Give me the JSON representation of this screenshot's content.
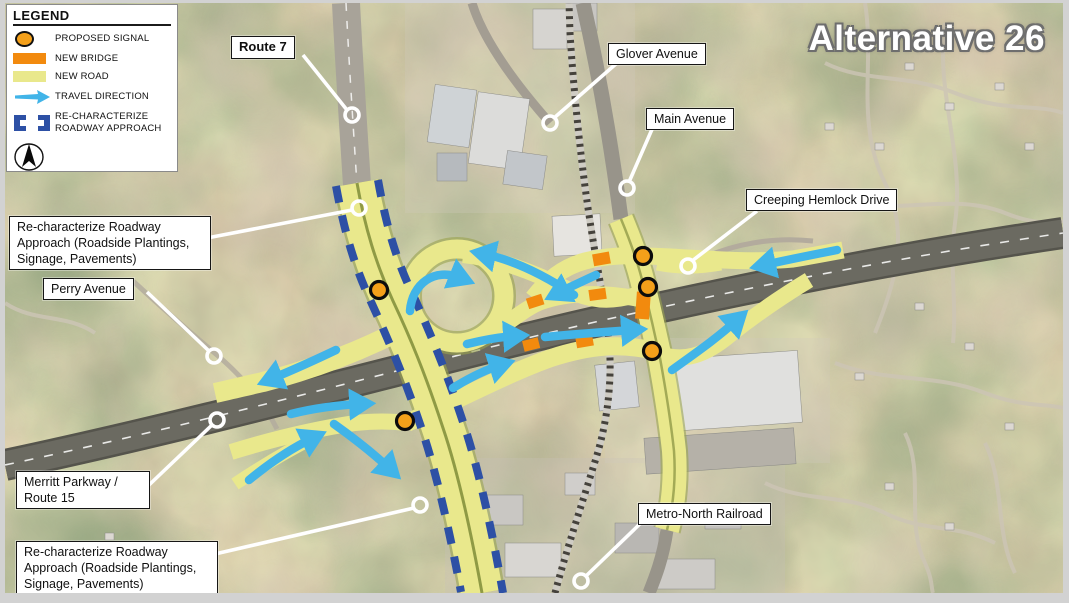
{
  "slide": {
    "title": "Alternative 26"
  },
  "legend": {
    "title": "LEGEND",
    "items": [
      {
        "name": "proposed-signal",
        "label": "PROPOSED SIGNAL",
        "color": "#F4A01A"
      },
      {
        "name": "new-bridge",
        "label": "NEW BRIDGE",
        "color": "#F28A0E"
      },
      {
        "name": "new-road",
        "label": "NEW ROAD",
        "color": "#E9E88C"
      },
      {
        "name": "travel-direction",
        "label": "TRAVEL DIRECTION",
        "color": "#41B4E8"
      },
      {
        "name": "re-characterize-roadway-approach",
        "label": "RE-CHARACTERIZE ROADWAY APPROACH",
        "color": "#2D50A5"
      }
    ],
    "north_arrow": "north-compass"
  },
  "callouts": {
    "route7": "Route 7",
    "glover": "Glover Avenue",
    "main": "Main Avenue",
    "creeping": "Creeping Hemlock Drive",
    "perry": "Perry Avenue",
    "recharN": "Re-characterize Roadway Approach (Roadside Plantings, Signage, Pavements)",
    "merritt": "Merritt Parkway / Route 15",
    "metro": "Metro-North Railroad",
    "recharS": "Re-characterize Roadway Approach (Roadside Plantings, Signage, Pavements)"
  },
  "map": {
    "overlay_colors": {
      "new_road": "#E9E88C",
      "new_bridge": "#F28A0E",
      "proposed_signal": "#F4A01A",
      "travel_direction": "#41B4E8",
      "re_characterize_dash": "#2D50A5",
      "leader_line": "#FFFFFF"
    },
    "proposed_signal_count": 5,
    "new_bridge_count": 6
  }
}
